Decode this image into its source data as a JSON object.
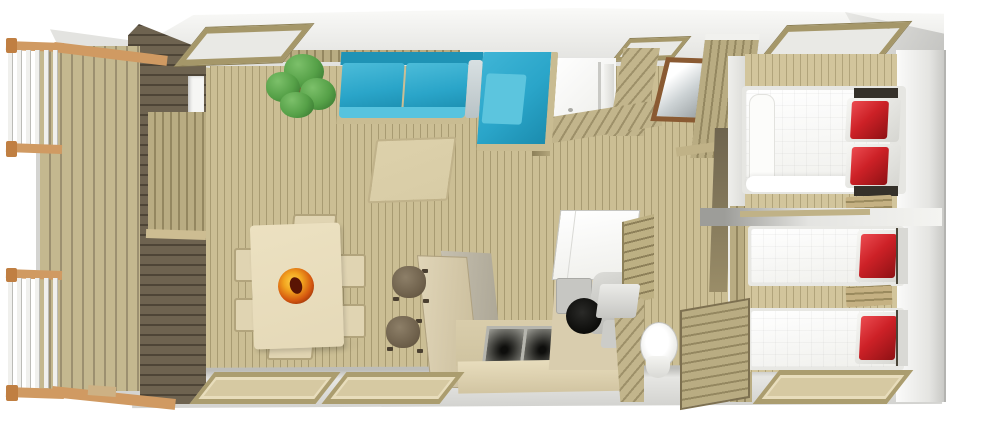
{
  "title": "3D cutaway floor plan of a mobile home with terrace",
  "view": "isometric top-down cutaway rendering, no text labels",
  "palette": {
    "floor": "#cbbe94",
    "floor-line": "#a89b72",
    "floor-light": "#d2c59c",
    "floor-light-line": "#b1a47b",
    "deck": "#c4b88f",
    "deck-line": "#9c9070",
    "dark-wall": "#6e6350",
    "dark-wall-line": "#4e4537",
    "wall-tan": "#b9ac82",
    "wall-tan-line": "#948760",
    "hatch": "#c2b58c",
    "hatch-dark": "#9d9069",
    "roof-light": "#fafaf8",
    "roof-dark": "#c2c2bf",
    "rail-wood": "#d09a62",
    "rail-post": "#c07f42",
    "sofa-blue": "#2aa5c9",
    "sofa-blue-light": "#57c3de",
    "sofa-blue-dark": "#1f93b5",
    "sofa-frame": "#c9bc92",
    "rug": "#d8cca6",
    "table-cream": "#e5d9b8",
    "chair-cream": "#e0d4b2",
    "stool": "#6b5d48",
    "stool-light": "#8d7f68",
    "bowl-rim-yellow": "#ffd24a",
    "bowl-orange": "#f2a41f",
    "bowl-core": "#6d1a06",
    "plant": "#55a047",
    "plant-light": "#7cc06a",
    "plant-dark": "#33702c",
    "fridge": "#ffffff",
    "appliance": "#c6c6c2",
    "sink-dark": "#1c1c1a",
    "bed-white": "#f7f7f4",
    "pillow-red": "#cd2127",
    "pillow-red-light": "#e8474c",
    "pillow-red-dark": "#8e1114",
    "headboard-dark": "#35312a",
    "mirror-frame": "#8a5a32",
    "toilet-white": "#ffffff",
    "window-frame": "#ab9d6f",
    "window-inner": "#d6c9a2",
    "skylight-frame": "#a59769",
    "shadow": "rgba(0,0,0,0.12)"
  },
  "areas": [
    {
      "id": "terrace",
      "contents": [
        "wood-deck",
        "white-baluster-railing-top",
        "white-baluster-railing-bottom",
        "wood-step"
      ]
    },
    {
      "id": "living-dining-room",
      "contents": [
        "blue-corner-sofa",
        "green-plant",
        "beige-rug",
        "dining-table",
        "fruit-bowl",
        "six-dining-chairs",
        "two-dark-stools",
        "skylight",
        "two-bottom-windows"
      ]
    },
    {
      "id": "kitchen",
      "contents": [
        "angled-bar-counter",
        "double-sink-counter",
        "refrigerator",
        "oven",
        "round-hob",
        "ladder-shelf-wall"
      ]
    },
    {
      "id": "shower-room",
      "contents": [
        "shower-stall",
        "small-skylight",
        "diagonal-plank-walls"
      ]
    },
    {
      "id": "wc-room",
      "contents": [
        "toilet",
        "cistern",
        "diagonal-plank-wall"
      ]
    },
    {
      "id": "hallway",
      "contents": [
        "mirror",
        "wardrobe",
        "door-opening"
      ]
    },
    {
      "id": "bedroom-double",
      "contents": [
        "double-bed-white",
        "two-red-pillows",
        "wood-shelf",
        "skylight",
        "wardrobe"
      ]
    },
    {
      "id": "bedroom-twin",
      "contents": [
        "single-bed-1",
        "single-bed-2",
        "two-red-pillows",
        "wood-shelf",
        "wardrobe",
        "bottom-window"
      ]
    }
  ]
}
